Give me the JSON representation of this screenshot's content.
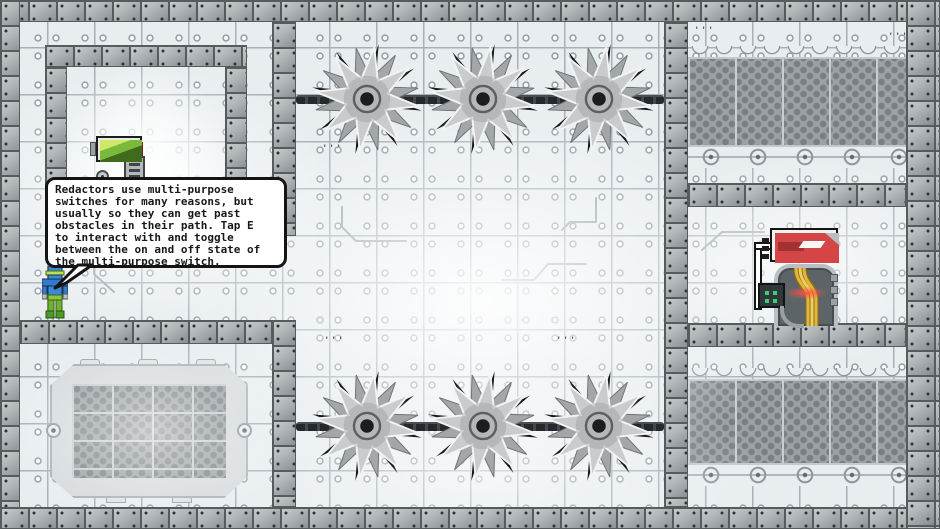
{
  "game": {
    "name": "pixel platformer level"
  },
  "bubble": {
    "text": "Redactors use multi-purpose\nswitches for many reasons, but\nusually so they can get past\nobstacles in their path. Tap E\nto interact with and toggle\nbetween the on and off state of\nthe multi-purpose switch.",
    "interact_key": "E"
  },
  "entities": {
    "player": "redactor",
    "switch_machine": "multi-purpose switch",
    "wall_machine": "cable machine with warning sign",
    "saw_blade": "spinning saw blade",
    "saw_count": 6
  },
  "decor": {
    "tick_marks": "'''"
  },
  "colors": {
    "bg_tile": "#e8edf0",
    "tile_line": "#9aa4a8",
    "wall_tile": "#a2a7aa",
    "wall_shadow": "#565b5e",
    "saw_gray": "#c9cbcd",
    "bubble_bg": "#ffffff",
    "bubble_border": "#141414",
    "screen_green": "#9ed24a",
    "cable_yellow": "#dcb031",
    "sign_red": "#d64545",
    "glow_red": "#ff5a50",
    "led_green": "#3ad06e",
    "player_blue": "#3b88d8",
    "player_green": "#7ab934"
  }
}
